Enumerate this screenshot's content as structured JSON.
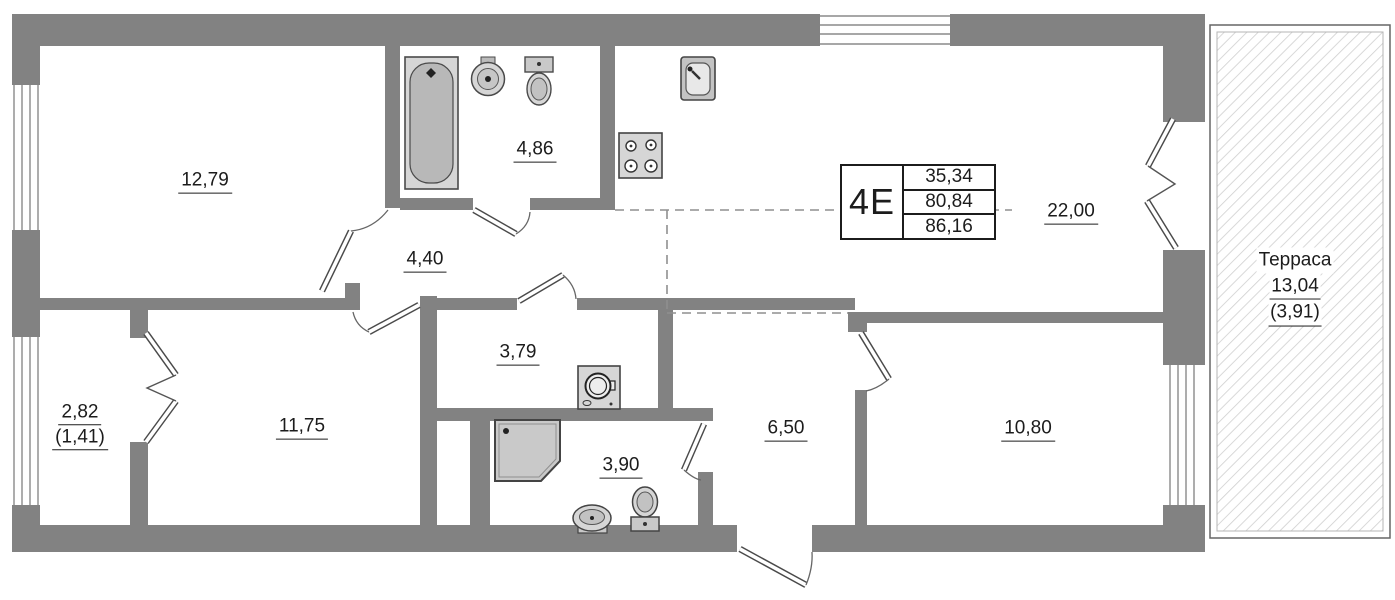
{
  "unit_info": {
    "unit": "4Е",
    "area_rows": [
      "35,34",
      "80,84",
      "86,16"
    ]
  },
  "rooms": [
    {
      "value": "12,79"
    },
    {
      "value": "4,86"
    },
    {
      "value": "4,40"
    },
    {
      "value": "22,00"
    },
    {
      "value": "3,79"
    },
    {
      "value": "11,75"
    },
    {
      "value": "2,82",
      "sub": "(1,41)"
    },
    {
      "value": "3,90"
    },
    {
      "value": "6,50"
    },
    {
      "value": "10,80"
    }
  ],
  "terrace": {
    "name": "Терраса",
    "area": "13,04",
    "area_reduced": "(3,91)"
  },
  "colors": {
    "wall": "#828282",
    "line": "#444444",
    "hatch": "#cfcfcf",
    "fixture_fill": "#d6d6d6",
    "text": "#1c1c1c"
  }
}
